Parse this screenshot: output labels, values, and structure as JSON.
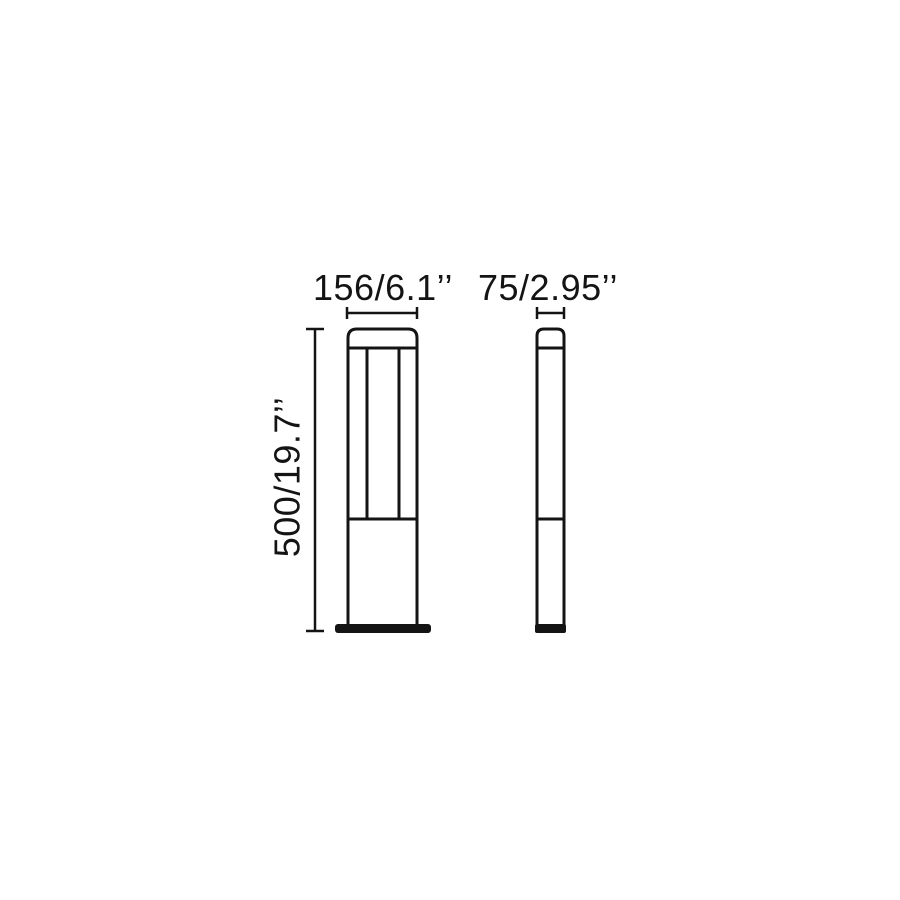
{
  "canvas": {
    "background_color": "#ffffff",
    "line_color": "#141414"
  },
  "drawing": {
    "description": "Technical dimension drawing of a rectangular bollard light, front view and side view",
    "dimension_labels": {
      "front_width": "156/6.1’’",
      "side_width": "75/2.95’’",
      "height": "500/19.7’’"
    }
  }
}
